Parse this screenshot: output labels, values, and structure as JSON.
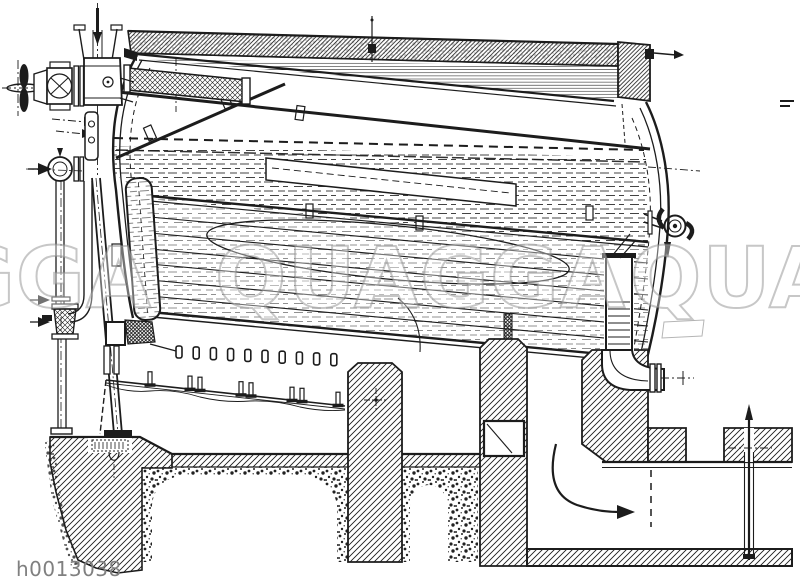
{
  "figure": {
    "subject": "Steam boiler longitudinal section — historical technical engraving"
  },
  "watermark": {
    "text": "QUAGGA",
    "fragments": [
      "GGA",
      "QUAGGA",
      "QUA"
    ],
    "color": "#8f8f8f"
  },
  "image_label": {
    "text": "h0013038",
    "color": "#808080"
  },
  "colors": {
    "ink": "#1c1c1c",
    "paper": "#ffffff"
  }
}
